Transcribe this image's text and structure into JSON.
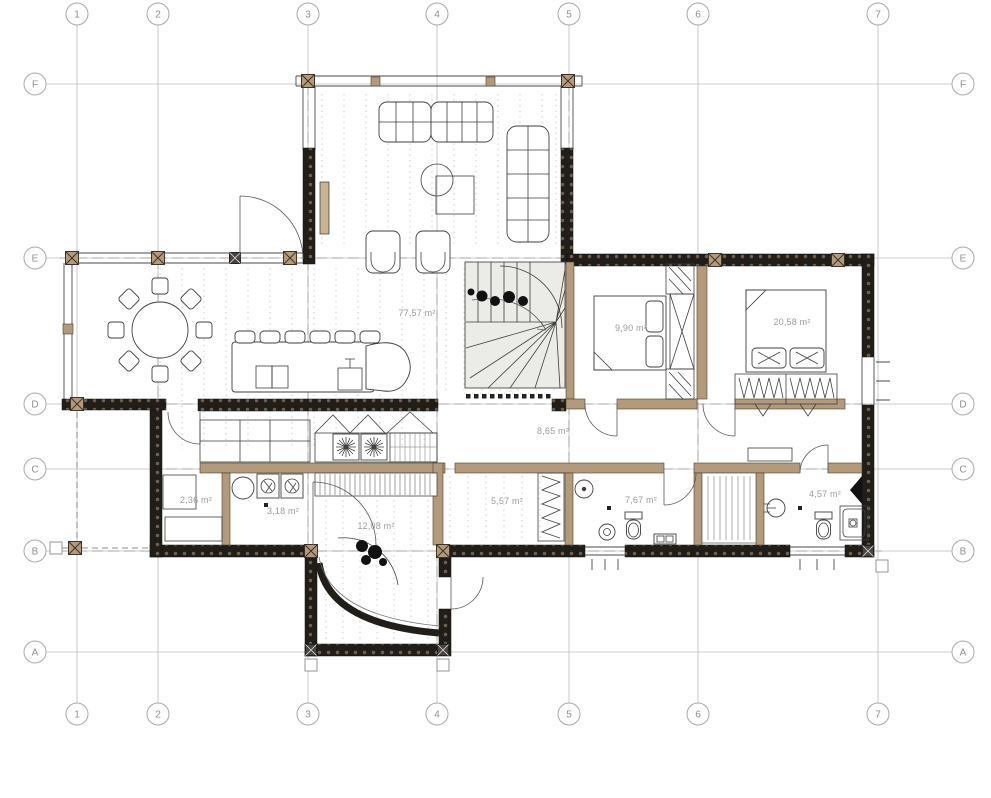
{
  "drawing": {
    "type": "architectural-floor-plan",
    "floor": "ground-floor"
  },
  "grid": {
    "columns": [
      "1",
      "2",
      "3",
      "4",
      "5",
      "6",
      "7"
    ],
    "rows": [
      "F",
      "E",
      "D",
      "C",
      "B",
      "A"
    ]
  },
  "rooms": [
    {
      "id": "great-room",
      "area_label": "77,57 m²"
    },
    {
      "id": "bedroom-small",
      "area_label": "9,90 m²"
    },
    {
      "id": "bedroom-master",
      "area_label": "20,58 m²"
    },
    {
      "id": "hall",
      "area_label": "8,65 m²"
    },
    {
      "id": "corridor",
      "area_label": "5,57 m²"
    },
    {
      "id": "bathroom",
      "area_label": "7,67 m²"
    },
    {
      "id": "bathroom-2",
      "area_label": "4,57 m²"
    },
    {
      "id": "pantry",
      "area_label": "2,36 m²"
    },
    {
      "id": "utility",
      "area_label": "3,18 m²"
    },
    {
      "id": "entrance-hall",
      "area_label": "12,08 m²"
    }
  ],
  "colors": {
    "wall_dark": "#211d19",
    "wall_wood": "#b49a7c",
    "grid_line": "#bcbcbc",
    "label_gray": "#9b9b9b",
    "paper": "#ffffff"
  }
}
